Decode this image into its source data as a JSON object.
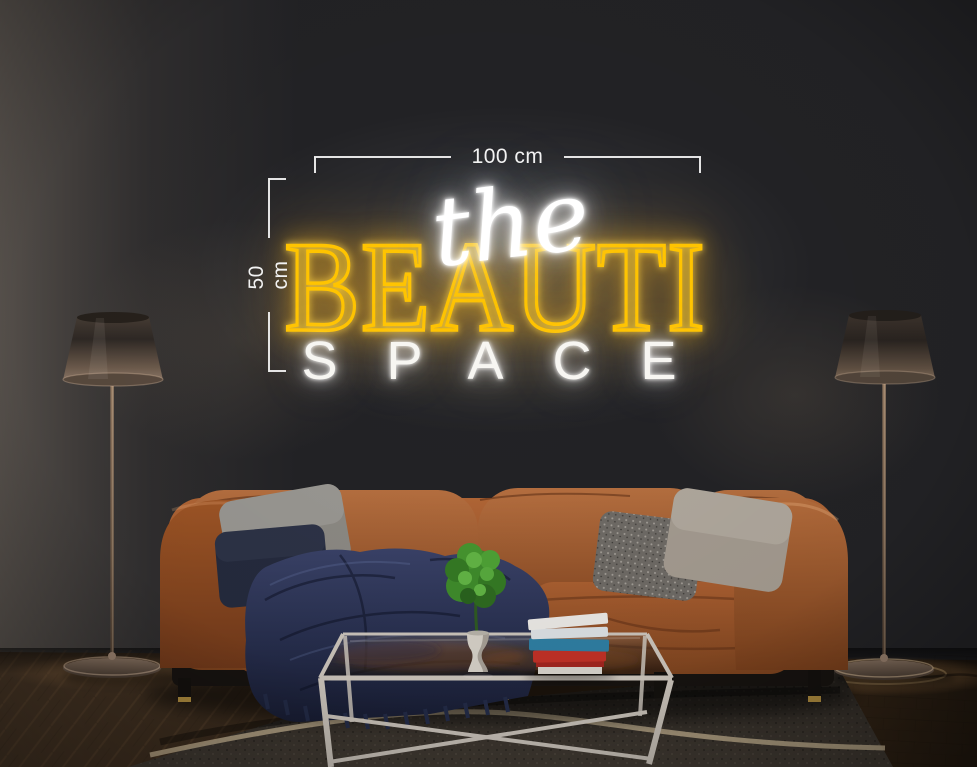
{
  "neon_sign": {
    "script_word": "the",
    "main_word": "BEAUTI",
    "bottom_word": "SPACE",
    "script_color": "#ffffff",
    "main_color": "#ffc400",
    "bottom_color": "#f7f6f2"
  },
  "annotations": {
    "width_label": "100 cm",
    "height_label": "50 cm",
    "line_color": "#eeeeee"
  },
  "scene": {
    "wall_color": "#232326",
    "floor_wood_color": "#4a3827",
    "rug_color": "#453e36",
    "rug_stripe_color": "#c9b795",
    "sofa": {
      "leather_color": "#a35c2f",
      "blanket_color": "#2b3252",
      "pillow_left_gray": "#8d8a84",
      "pillow_left_navy": "#252b3e",
      "pillow_right_pattern": "#6f6b66",
      "pillow_right_light": "#a59c91"
    },
    "coffee_table": {
      "frame_color": "#ccc5bc"
    },
    "books": {
      "top": "#eceae6",
      "second": "#dde2e5",
      "teal": "#2f7fa3",
      "red": "#c23127",
      "pages": "#d8d4cd"
    },
    "plant": {
      "foliage": "#3f8c2c",
      "vase": "#d6d1c8"
    },
    "lamps": {
      "shade_top": "#3b332d",
      "shade_bottom": "#7d6a5c",
      "stem": "#8a6f58"
    }
  }
}
